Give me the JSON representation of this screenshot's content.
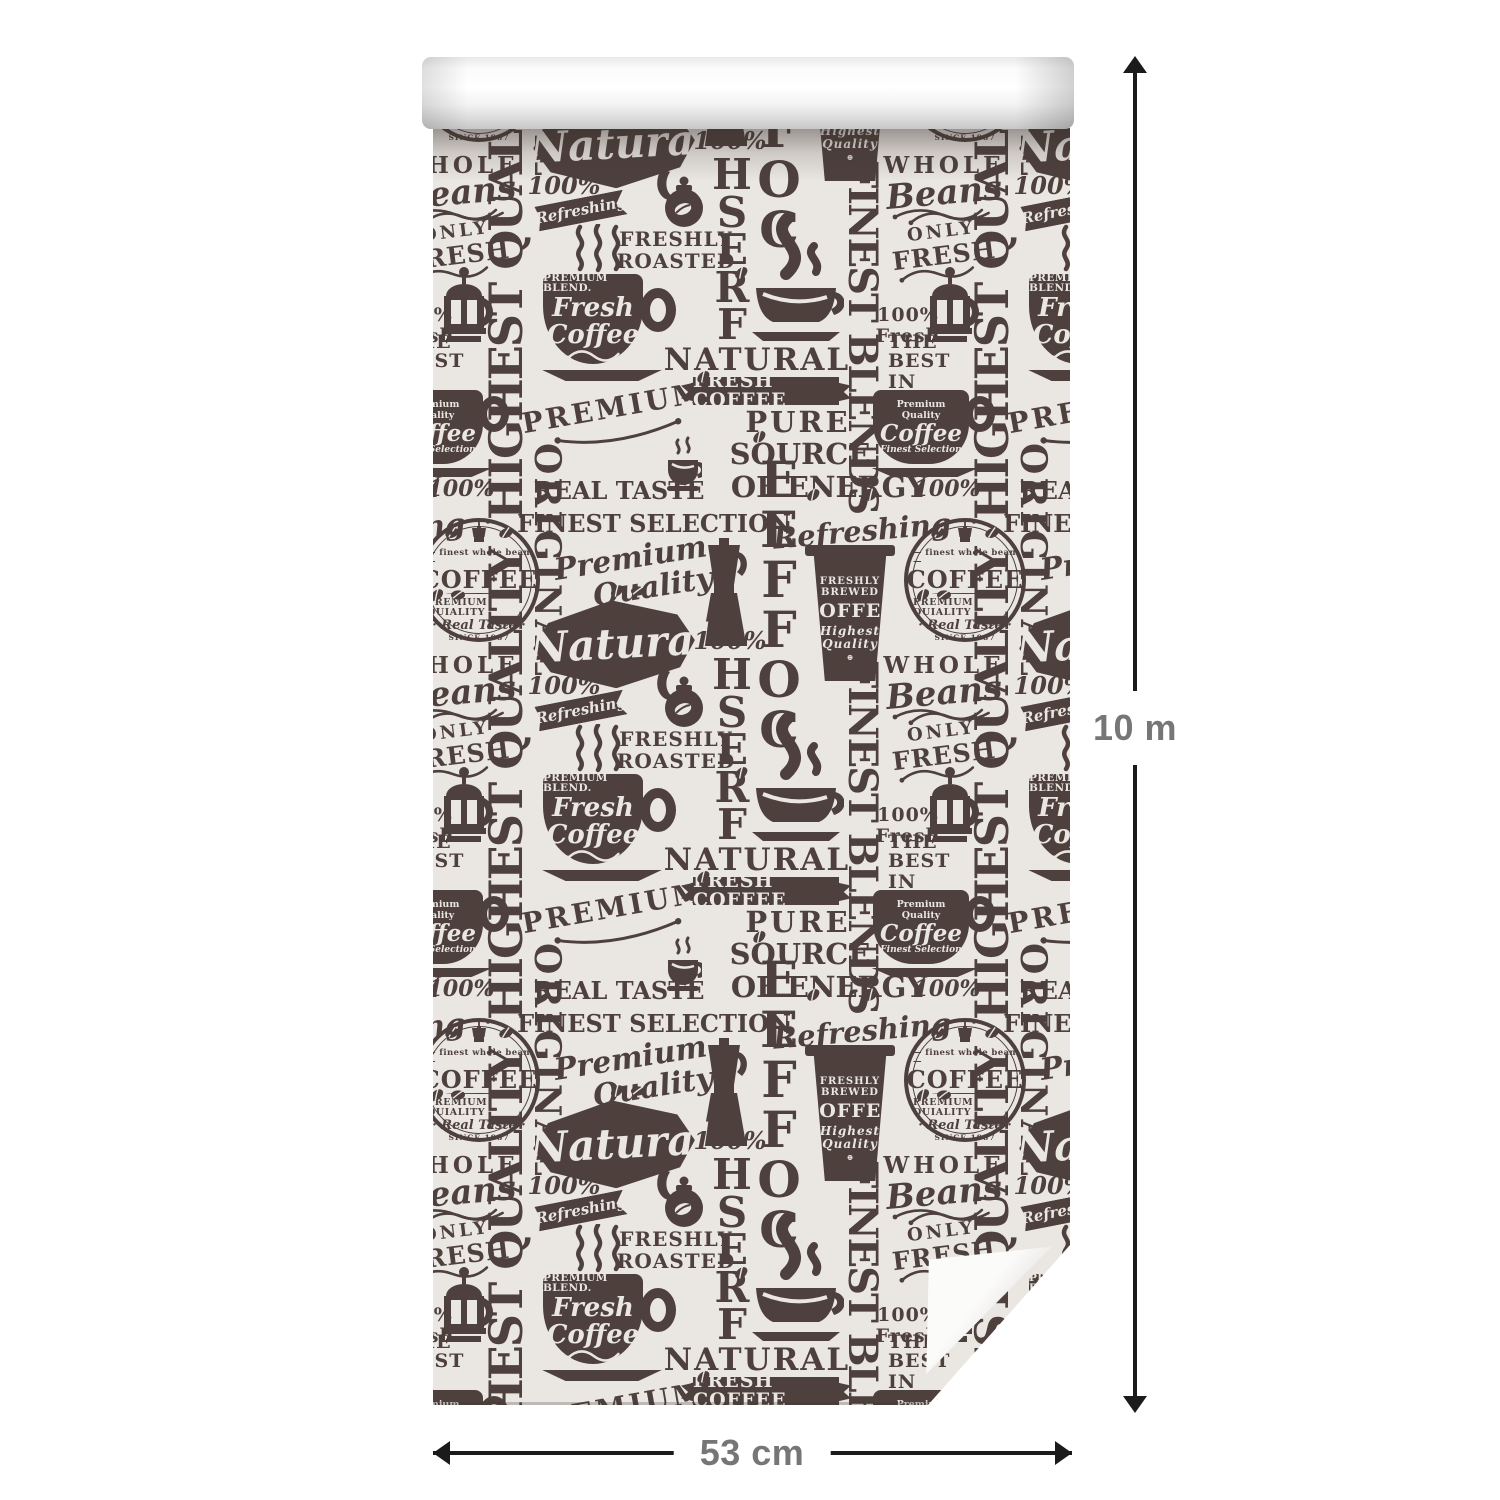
{
  "labels": {
    "height": "10 m",
    "width": "53 cm"
  },
  "colors": {
    "ink": "#483b38",
    "paper": "#eae6e2",
    "arrow": "#1b1b1b",
    "dimension_text": "#767676"
  },
  "pattern": {
    "repeat_x": 486,
    "repeat_y": 500,
    "items": [
      {
        "n": "highest-quality-vertical",
        "t": "vup",
        "x": 42,
        "y": 7,
        "w": 62,
        "h": 365,
        "fs": 46,
        "ls": -2,
        "text": "HIGHEST QUALITY"
      },
      {
        "n": "coffee-badge",
        "t": "badge",
        "x": -15,
        "y": 370,
        "w": 122,
        "h": 124,
        "top": "finest whole bean",
        "main": "COFFEE",
        "sub": "PREMIUM QUIALITY",
        "taste": "Real Taste",
        "since": "SINCE 1987"
      },
      {
        "n": "original-vertical",
        "t": "vdown",
        "x": 97,
        "y": -205,
        "w": 33,
        "h": 215,
        "fs": 36,
        "ls": 3,
        "text": "ORIGINAL"
      },
      {
        "n": "real-taste",
        "t": "text",
        "x": 132,
        "y": -170,
        "w": 108,
        "h": 26,
        "fs": 24,
        "text": "REAL TASTE"
      },
      {
        "n": "steaming-cup-small",
        "t": "cupsteam",
        "x": 233,
        "y": -212,
        "w": 36,
        "h": 64
      },
      {
        "n": "finest-selection",
        "t": "text",
        "x": 132,
        "y": -138,
        "w": 178,
        "h": 27,
        "fs": 24,
        "text": "FINEST SELECTION"
      },
      {
        "n": "premium-quality-script",
        "t": "script2",
        "x": 123,
        "y": -106,
        "w": 152,
        "h": 66,
        "fs": 30,
        "rot": -9,
        "lines": [
          "Premium",
          "Quality"
        ]
      },
      {
        "n": "moka-pot",
        "t": "moka",
        "x": 265,
        "y": -110,
        "w": 52,
        "h": 108
      },
      {
        "n": "natural-diamond",
        "t": "diamond",
        "x": 92,
        "y": -52,
        "w": 190,
        "h": 96,
        "fs": 42,
        "rot": -3,
        "text": "Natural"
      },
      {
        "n": "hundred-percent",
        "t": "text",
        "x": 107,
        "y": 24,
        "w": 48,
        "h": 27,
        "fs": 24,
        "ital": true,
        "text": "100%"
      },
      {
        "n": "refreshing-ribbon",
        "t": "ribbon",
        "x": 103,
        "y": 50,
        "w": 90,
        "h": 25,
        "fs": 15,
        "rot": -11,
        "text": "Refreshing"
      },
      {
        "n": "kettle",
        "t": "kettle",
        "x": 219,
        "y": 16,
        "w": 52,
        "h": 66
      },
      {
        "n": "freshly-roasted",
        "t": "lines",
        "x": 197,
        "y": 78,
        "w": 92,
        "h": 48,
        "fs": 20,
        "lines": [
          "FRESHLY",
          "ROASTED"
        ]
      },
      {
        "n": "steam-lines",
        "t": "steam3",
        "x": 137,
        "y": 76,
        "w": 56,
        "h": 66
      },
      {
        "n": "beans-trio",
        "t": "beans",
        "x": 159,
        "y": 150,
        "w": 34,
        "h": 66,
        "k": 3
      },
      {
        "n": "fresh-coffee-cup",
        "t": "cup",
        "x": 110,
        "y": 126,
        "w": 140,
        "h": 118,
        "lines": [
          "PREMIUM BLEND.",
          "Fresh",
          "Coffee"
        ]
      },
      {
        "n": "premium-arc",
        "t": "arc",
        "x": 112,
        "y": 244,
        "w": 142,
        "h": 56,
        "fs": 28,
        "rot": -10,
        "text": "PREMIUM"
      },
      {
        "n": "hundred-percent-2",
        "t": "text",
        "x": 270,
        "y": -20,
        "w": 54,
        "h": 26,
        "fs": 24,
        "ital": true,
        "text": "100%"
      },
      {
        "n": "fresh-vertical",
        "t": "stack",
        "x": 273,
        "y": 8,
        "w": 52,
        "h": 188,
        "fs": 42,
        "text": "FRESH"
      },
      {
        "n": "coffee-vertical",
        "t": "stack",
        "x": 317,
        "y": -193,
        "w": 58,
        "h": 300,
        "fs": 50,
        "text": "COFFEE"
      },
      {
        "n": "steam-cup-large",
        "t": "bigsteamcup",
        "x": 315,
        "y": 64,
        "w": 96,
        "h": 136
      },
      {
        "n": "natural-caps",
        "t": "text",
        "x": 235,
        "y": 195,
        "w": 178,
        "h": 34,
        "fs": 31,
        "ls": 2,
        "text": "NATURAL"
      },
      {
        "n": "fresh-coffee-banner",
        "t": "banner",
        "x": 252,
        "y": 229,
        "w": 162,
        "h": 28,
        "fs": 19,
        "text": "FRESH COFFEE"
      },
      {
        "n": "pure",
        "t": "text",
        "x": 309,
        "y": 258,
        "w": 112,
        "h": 32,
        "fs": 29,
        "ls": 3,
        "text": "PURE"
      },
      {
        "n": "source",
        "t": "text",
        "x": 305,
        "y": 290,
        "w": 124,
        "h": 32,
        "fs": 29,
        "text": "SOURCE"
      },
      {
        "n": "of-energy",
        "t": "text",
        "x": 303,
        "y": 322,
        "w": 186,
        "h": 34,
        "fs": 29,
        "text": "OF ENERGY"
      },
      {
        "n": "hundred-percent-3",
        "t": "text",
        "x": 485,
        "y": 329,
        "w": 58,
        "h": 24,
        "fs": 22,
        "ital": true,
        "text": "100%"
      },
      {
        "n": "refreshing-script",
        "t": "script",
        "x": 365,
        "y": 364,
        "w": 128,
        "h": 38,
        "fs": 29,
        "rot": -5,
        "text": "Refreshing"
      },
      {
        "n": "paper-cup",
        "t": "papercup",
        "x": 375,
        "y": -103,
        "w": 84,
        "h": 136,
        "lines": [
          "FRESHLY",
          "BREWED",
          "COFFEE",
          "Highest",
          "Quality"
        ]
      },
      {
        "n": "finest-blends-vertical",
        "t": "vdown",
        "x": 409,
        "y": 12,
        "w": 40,
        "h": 292,
        "fs": 40,
        "ls": -2,
        "text": "FINEST BLENDS"
      },
      {
        "n": "whole-beans",
        "t": "wholebeans",
        "x": 454,
        "y": 8,
        "w": 114,
        "h": 66,
        "lines": [
          "WHOLE",
          "Beans"
        ]
      },
      {
        "n": "only-fresh",
        "t": "onlyfresh",
        "x": 462,
        "y": 76,
        "w": 96,
        "h": 44,
        "rot": -7,
        "lines": [
          "ONLY",
          "FRESH"
        ]
      },
      {
        "n": "french-press",
        "t": "press",
        "x": 487,
        "y": 118,
        "w": 60,
        "h": 84
      },
      {
        "n": "hundred-fresh",
        "t": "lines",
        "x": 447,
        "y": 156,
        "w": 56,
        "h": 44,
        "fs": 19,
        "lines": [
          "100%",
          "Fresh"
        ]
      },
      {
        "n": "best-in-town",
        "t": "lines",
        "x": 455,
        "y": 204,
        "w": 106,
        "h": 40,
        "fs": 19,
        "lines": [
          "THE BEST",
          "IN TOWN"
        ]
      },
      {
        "n": "premium-coffee-cup",
        "t": "cupR",
        "x": 440,
        "y": 242,
        "w": 118,
        "h": 86,
        "lines": [
          "Premium Quality",
          "Coffee",
          "Finest Selection"
        ]
      },
      {
        "n": "coffee-bean",
        "t": "beans",
        "x": 318,
        "y": -218,
        "w": 16,
        "h": 12,
        "k": 1
      },
      {
        "n": "coffee-bean",
        "t": "beans",
        "x": 430,
        "y": -160,
        "w": 16,
        "h": 12,
        "k": 1
      },
      {
        "n": "coffee-bean",
        "t": "beans",
        "x": 482,
        "y": -60,
        "w": 30,
        "h": 14,
        "k": 2
      },
      {
        "n": "coffee-bean",
        "t": "beans",
        "x": 262,
        "y": 222,
        "w": 16,
        "h": 12,
        "k": 1
      },
      {
        "n": "coffee-bean",
        "t": "beans",
        "x": 372,
        "y": 340,
        "w": 16,
        "h": 12,
        "k": 1
      },
      {
        "n": "coffee-bean",
        "t": "beans",
        "x": 176,
        "y": -64,
        "w": 30,
        "h": 14,
        "k": 2
      },
      {
        "n": "coffee-bean",
        "t": "beans",
        "x": 300,
        "y": 118,
        "w": 16,
        "h": 12,
        "k": 1
      }
    ]
  }
}
